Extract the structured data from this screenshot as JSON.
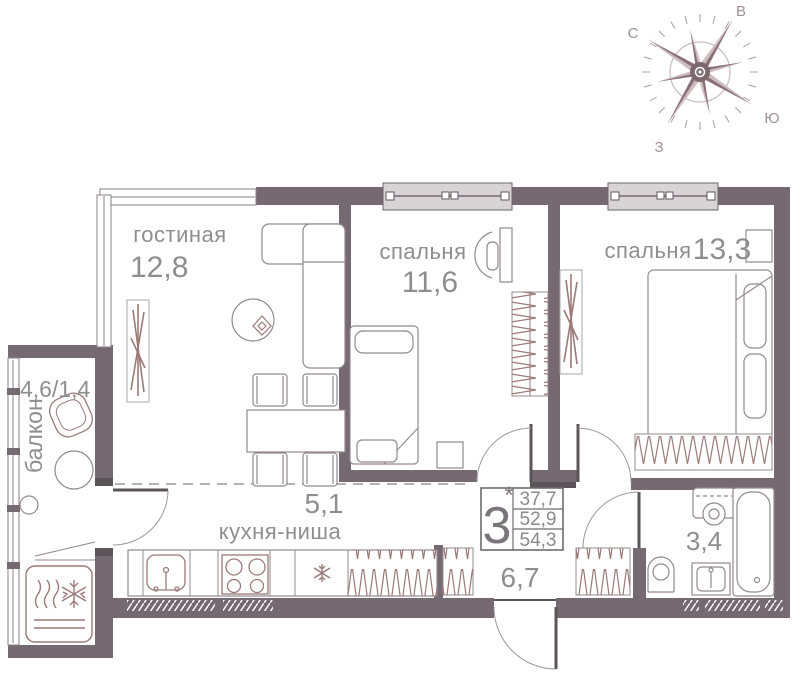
{
  "compass": {
    "n": "С",
    "e": "В",
    "s": "Ю",
    "w": "З"
  },
  "rooms": {
    "living": {
      "label": "гостиная",
      "area": "12,8"
    },
    "bedroom1": {
      "label": "спальня",
      "area": "11,6"
    },
    "bedroom2": {
      "label": "спальня",
      "area": "13,3"
    },
    "balcony": {
      "label": "балкон",
      "area": "4,6/1,4"
    },
    "kitchen": {
      "label": "кухня-ниша",
      "area": "5,1"
    },
    "hallway": {
      "area": "6,7"
    },
    "bathroom": {
      "area": "3,4"
    }
  },
  "stamp": {
    "rooms_count": "3",
    "asterisk": "*",
    "areas": [
      "37,7",
      "52,9",
      "54,3"
    ]
  },
  "colors": {
    "wall": "#756a71",
    "wall_dark": "#5b5458",
    "window_fill": "#d8d4d6",
    "furniture": "#94898d",
    "accent_brown": "#9b7a78",
    "label_text": "#8e8e8e"
  }
}
